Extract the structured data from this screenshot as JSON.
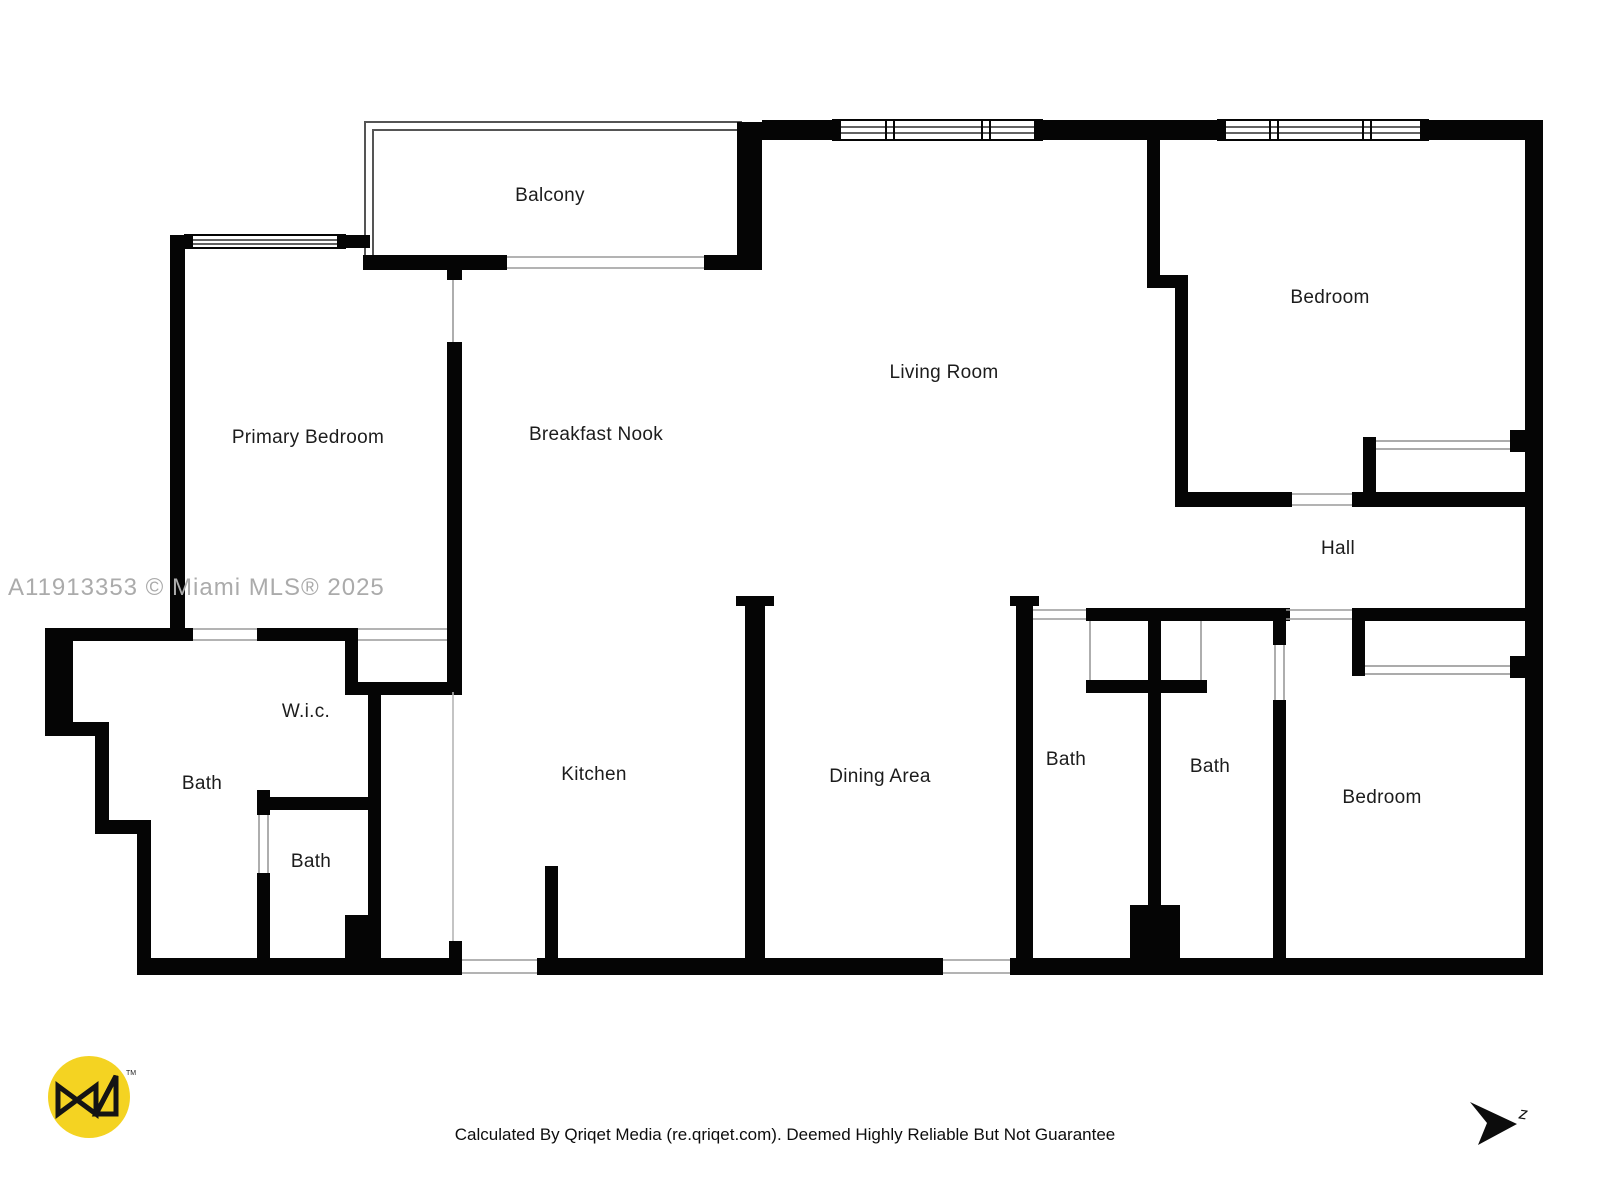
{
  "watermark": "A11913353 © Miami MLS® 2025",
  "footer": "Calculated By Qriqet Media (re.qriqet.com). Deemed Highly Reliable But Not Guarantee",
  "north_letter": "z",
  "logo_tm": "TM",
  "colors": {
    "wall": "#050505",
    "thin_line": "#8f8f8f",
    "counter_line": "#b5b5b5",
    "watermark": "#ababab",
    "logo_yellow": "#f4d322",
    "background": "#ffffff"
  },
  "rooms": [
    {
      "label": "Balcony",
      "x": 550,
      "y": 196
    },
    {
      "label": "Primary Bedroom",
      "x": 308,
      "y": 438
    },
    {
      "label": "Breakfast Nook",
      "x": 596,
      "y": 435
    },
    {
      "label": "Living Room",
      "x": 944,
      "y": 373
    },
    {
      "label": "Bedroom",
      "x": 1330,
      "y": 298
    },
    {
      "label": "Hall",
      "x": 1338,
      "y": 549
    },
    {
      "label": "W.i.c.",
      "x": 306,
      "y": 712
    },
    {
      "label": "Bath",
      "x": 202,
      "y": 784
    },
    {
      "label": "Bath",
      "x": 311,
      "y": 862
    },
    {
      "label": "Kitchen",
      "x": 594,
      "y": 775
    },
    {
      "label": "Dining Area",
      "x": 880,
      "y": 777
    },
    {
      "label": "Bath",
      "x": 1066,
      "y": 760
    },
    {
      "label": "Bath",
      "x": 1210,
      "y": 767
    },
    {
      "label": "Bedroom",
      "x": 1382,
      "y": 798
    }
  ]
}
